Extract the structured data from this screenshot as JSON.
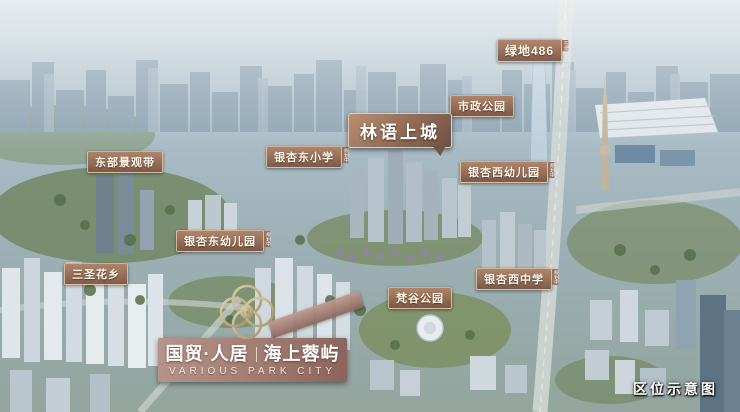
{
  "labels": {
    "greenland": {
      "text": "绿地486",
      "note": "在建"
    },
    "municipal_park": {
      "text": "市政公园"
    },
    "linyu": {
      "text": "林语上城"
    },
    "east_landscape": {
      "text": "东部景观带"
    },
    "yinxing_east_primary": {
      "text": "银杏东小学",
      "note": "规划中"
    },
    "yinxing_west_kindergarten": {
      "text": "银杏西幼儿园",
      "note": "规划中"
    },
    "yinxing_east_kindergarten": {
      "text": "银杏东幼儿园",
      "note": "规划中"
    },
    "sansheng": {
      "text": "三圣花乡"
    },
    "yinxing_west_middle": {
      "text": "银杏西中学",
      "note": "规划中"
    },
    "fangu_park": {
      "text": "梵谷公园"
    }
  },
  "brand": {
    "cn_left": "国贸·人居",
    "cn_right": "海上蓉屿",
    "en": "VARIOUS PARK CITY"
  },
  "corner_note": {
    "text": "区位示意图"
  },
  "accent_colors": {
    "label_bg": "#9a715c",
    "label_border": "#ead9c4",
    "ribbon": "#a17b72",
    "gold": "#cdb88f"
  }
}
